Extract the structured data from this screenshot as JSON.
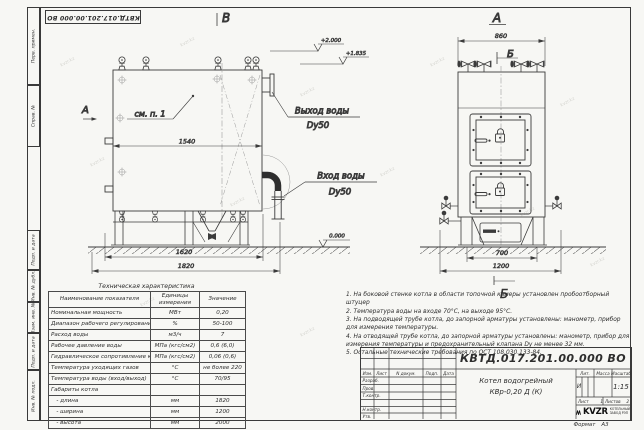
{
  "doc": {
    "designation": "КВТД.017.201.00.000 ВО",
    "name_line1": "Котел водогрейный",
    "name_line2": "КВр-0,20 Д (К)",
    "lit": "И",
    "scale": "1:15",
    "lit_label": "Лит.",
    "mass_label": "Масса",
    "scale_label": "Масштаб",
    "sheet_label": "Лист",
    "sheet_value": "1",
    "sheets_label": "Листов",
    "sheets_value": "2",
    "format_label": "Формат",
    "format_value": "А3",
    "logo_text": "KVZR",
    "logo_caption_line1": "КОТЕЛЬНЫЙ",
    "logo_caption_line2": "ЗАВОД РЭП",
    "col_izm": "Изм.",
    "col_list": "Лист",
    "col_doc": "N докум.",
    "col_sign": "Подп.",
    "col_date": "Дата",
    "row_razrab": "Разраб.",
    "row_prov": "Пров.",
    "row_tkontr": "Т.контр.",
    "row_nkontr": "Н.контр.",
    "row_utv": "Утв."
  },
  "frame": {
    "left_cells": [
      "Перв. примен.",
      "Справ. №",
      "Подп. и дата",
      "Инв. № дубл.",
      "Взам. инв. №",
      "Подп. и дата",
      "Инв. № подл."
    ]
  },
  "views": {
    "title_b": "В",
    "title_a": "А",
    "pointer_a": "А",
    "marker_b": "Б",
    "see_note": "см. п. 1",
    "outlet_line1": "Выход воды",
    "outlet_line2": "Dy50",
    "inlet_line1": "Вход воды",
    "inlet_line2": "Dy50",
    "elev_top": "+2.000",
    "elev_mid": "+1.835",
    "elev_zero": "0.000",
    "dim_width_inner": "1540",
    "dim_base": "1620",
    "dim_length": "1820",
    "dim_front_top": "860",
    "dim_front_base": "700",
    "dim_front_overall": "1200"
  },
  "table": {
    "title": "Техническая характеристика",
    "col_name": "Наименование показателя",
    "col_units": "Единицы измерения",
    "col_value": "Значение",
    "rows": [
      {
        "n": "Номинальная мощность",
        "u": "МВт",
        "v": "0,20"
      },
      {
        "n": "Диапазон рабочего регулирования",
        "u": "%",
        "v": "50-100"
      },
      {
        "n": "Расход воды",
        "u": "м3/ч",
        "v": "7"
      },
      {
        "n": "Рабочее давление воды",
        "u": "МПа (кгс/см2)",
        "v": "0,6 (6,0)"
      },
      {
        "n": "Гидравлическое сопротивление котла",
        "u": "МПа (кгс/см2)",
        "v": "0,06 (0,6)"
      },
      {
        "n": "Температура уходящих газов",
        "u": "°С",
        "v": "не более 220"
      },
      {
        "n": "Температура воды (вход/выход)",
        "u": "°С",
        "v": "70/95"
      },
      {
        "n": "Габариты котла",
        "u": "",
        "v": ""
      },
      {
        "n": "   - длина",
        "u": "мм",
        "v": "1820"
      },
      {
        "n": "   - ширина",
        "u": "мм",
        "v": "1200"
      },
      {
        "n": "   - высота",
        "u": "мм",
        "v": "2000"
      }
    ]
  },
  "notes": [
    "1. На боковой стенке котла в области топочной камеры установлен пробоотборный штуцер",
    "2. Температура воды на входе 70°С, на выходе 95°С.",
    "3. На подводящей трубе котла, до запорной арматуры установлены: манометр, прибор для измерения температуры.",
    "4. На отводящей трубе котла, до запорной арматуры установлены: манометр, прибор для измерения температуры и предохранительный клапана Dу не менее 32 мм.",
    "5. Остальные технические требования по ОСТ 108.030.133-84."
  ],
  "watermark": "kvzr.kz"
}
